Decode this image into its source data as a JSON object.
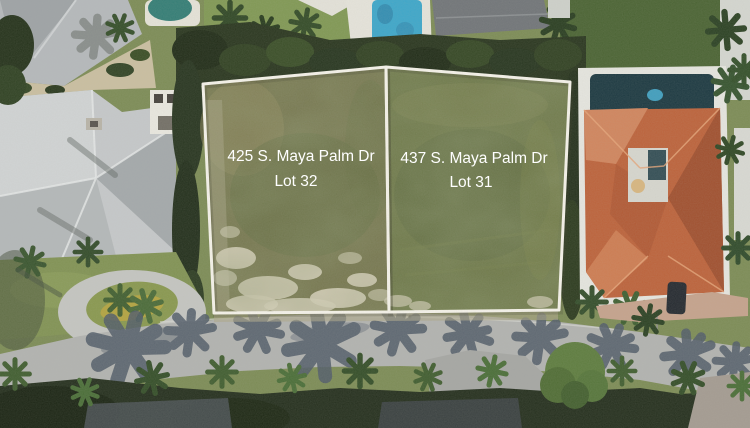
{
  "lot_overlay": {
    "outline_color": "#f8f5ec",
    "label_color": "#ffffff",
    "lots": [
      {
        "address": "425 S. Maya Palm Dr",
        "lot_label": "Lot 32"
      },
      {
        "address": "437 S. Maya Palm Dr",
        "lot_label": "Lot 31"
      }
    ]
  }
}
